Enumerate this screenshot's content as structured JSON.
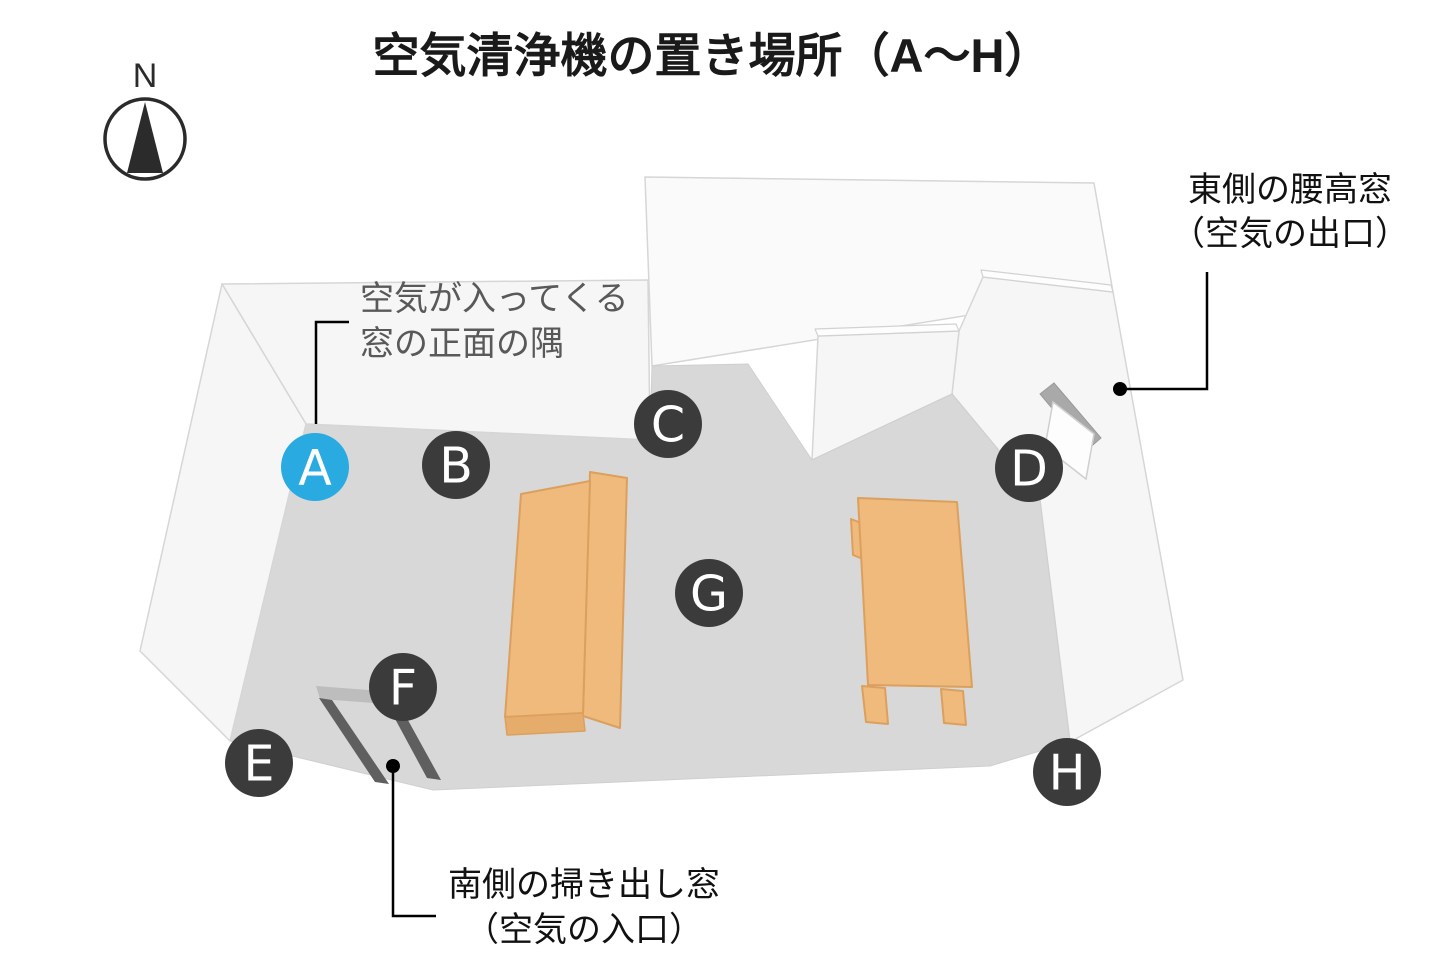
{
  "title": "空気清浄機の置き場所（A〜H）",
  "compass": {
    "label": "N"
  },
  "markers": [
    {
      "letter": "A",
      "color": "#29ABE2",
      "highlighted": true
    },
    {
      "letter": "B",
      "color": "#3B3B3C",
      "highlighted": false
    },
    {
      "letter": "C",
      "color": "#3B3B3C",
      "highlighted": false
    },
    {
      "letter": "D",
      "color": "#3B3B3C",
      "highlighted": false
    },
    {
      "letter": "E",
      "color": "#3B3B3C",
      "highlighted": false
    },
    {
      "letter": "F",
      "color": "#3B3B3C",
      "highlighted": false
    },
    {
      "letter": "G",
      "color": "#3B3B3C",
      "highlighted": false
    },
    {
      "letter": "H",
      "color": "#3B3B3C",
      "highlighted": false
    }
  ],
  "annotations": {
    "corner_note": {
      "line1": "空気が入ってくる",
      "line2": "窓の正面の隅"
    },
    "east_window": {
      "line1": "東側の腰高窓",
      "line2": "（空気の出口）"
    },
    "south_window": {
      "line1": "南側の掃き出し窓",
      "line2": "（空気の入口）"
    }
  },
  "colors": {
    "marker_highlight": "#29ABE2",
    "marker_default": "#3B3B3C",
    "floor": "#D8D8D8",
    "wall": "#F6F6F6",
    "furniture": "#EFBA7C"
  }
}
